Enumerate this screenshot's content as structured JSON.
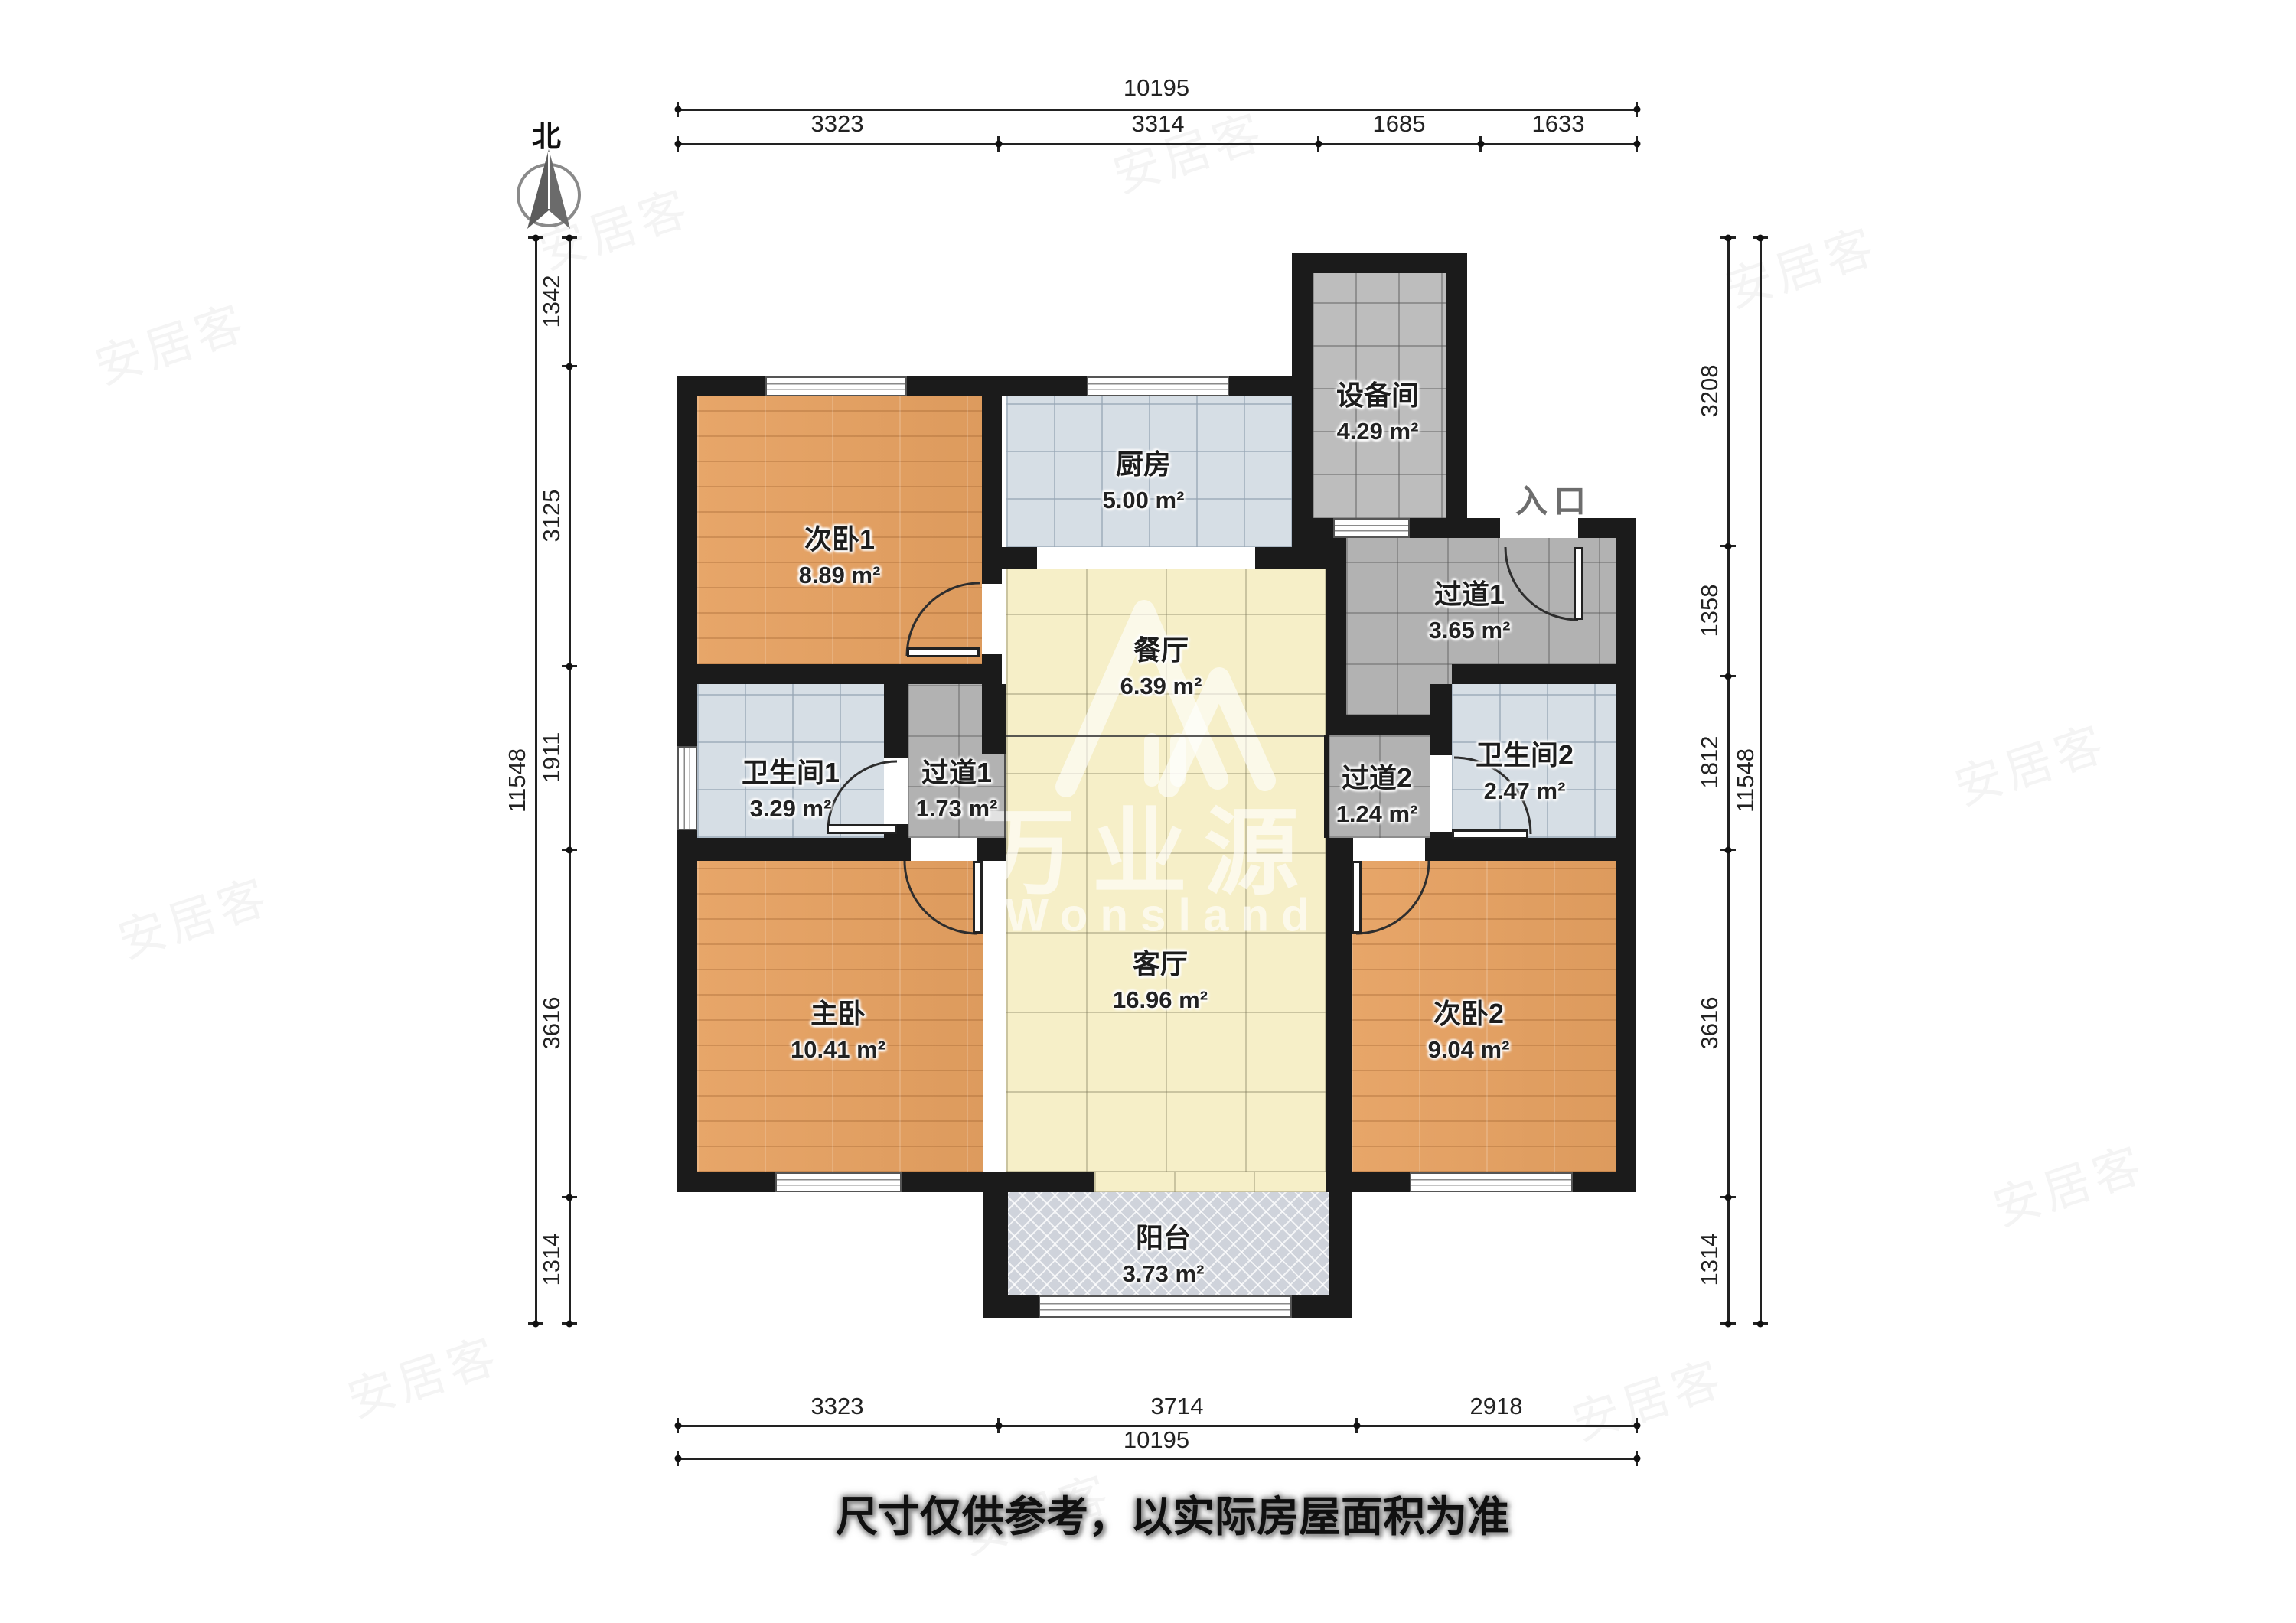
{
  "compass": {
    "label": "北"
  },
  "entrance": {
    "label": "入口"
  },
  "disclaimer": "尺寸仅供参考，以实际房屋面积为准",
  "watermark": {
    "brand_cn": "万业源",
    "brand_en": "Wonsland",
    "tile_text": "安居客"
  },
  "rooms": [
    {
      "id": "bedroom-1",
      "name": "次卧1",
      "area": "8.89 m²"
    },
    {
      "id": "kitchen",
      "name": "厨房",
      "area": "5.00 m²"
    },
    {
      "id": "equipment",
      "name": "设备间",
      "area": "4.29 m²"
    },
    {
      "id": "hall1-entry",
      "name": "过道1",
      "area": "3.65 m²"
    },
    {
      "id": "dining",
      "name": "餐厅",
      "area": "6.39 m²"
    },
    {
      "id": "bath-1",
      "name": "卫生间1",
      "area": "3.29 m²"
    },
    {
      "id": "hall1-mid",
      "name": "过道1",
      "area": "1.73 m²"
    },
    {
      "id": "hall-2",
      "name": "过道2",
      "area": "1.24 m²"
    },
    {
      "id": "bath-2",
      "name": "卫生间2",
      "area": "2.47 m²"
    },
    {
      "id": "master",
      "name": "主卧",
      "area": "10.41 m²"
    },
    {
      "id": "living",
      "name": "客厅",
      "area": "16.96 m²"
    },
    {
      "id": "bedroom-2",
      "name": "次卧2",
      "area": "9.04 m²"
    },
    {
      "id": "balcony",
      "name": "阳台",
      "area": "3.73 m²"
    }
  ],
  "dimensions": {
    "top": {
      "overall": "10195",
      "segments": [
        "3323",
        "3314",
        "1685",
        "1633"
      ]
    },
    "bottom": {
      "overall": "10195",
      "segments": [
        "3323",
        "3714",
        "2918"
      ]
    },
    "left": {
      "overall": "11548",
      "segments": [
        "1342",
        "3125",
        "1911",
        "3616",
        "1314"
      ]
    },
    "right": {
      "overall": "11548",
      "segments": [
        "3208",
        "1358",
        "1812",
        "3616",
        "1314"
      ]
    }
  },
  "palette": {
    "wall": "#1B1B1B",
    "wood": "#E6A161",
    "tile": "#D6DEE5",
    "living": "#F6EFC8",
    "corridor": "#B2B2B2",
    "balcony": "#CFD3DB"
  }
}
